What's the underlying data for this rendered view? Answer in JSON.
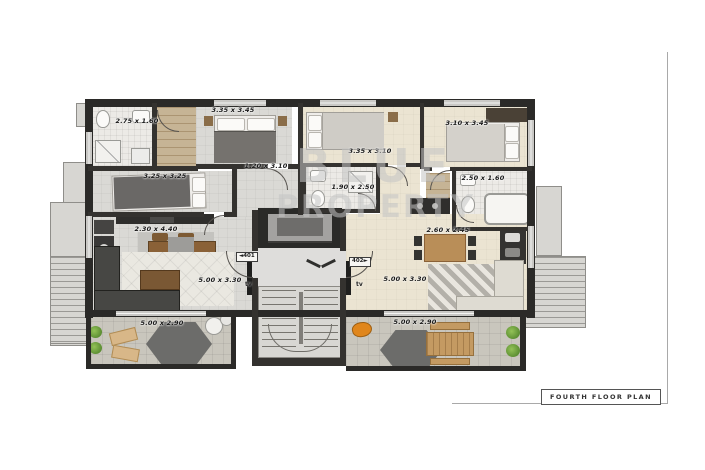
{
  "title_block": {
    "label": "FOURTH FLOOR PLAN"
  },
  "watermark": {
    "line1": "BLUE",
    "line2": "PROPERTY"
  },
  "units": {
    "left": {
      "tag": "◄401"
    },
    "right": {
      "tag": "402►"
    }
  },
  "labels": {
    "tv": "tv"
  },
  "dims": {
    "u401_bath": "2.75 x 1.60",
    "u401_bed1": "3.35 x 3.45",
    "u401_bed2": "3.25 x 3.25",
    "u401_hall": "1.20 x 3.10",
    "u401_dining": "2.30 x 4.40",
    "u401_living": "5.00 x 3.30",
    "u401_terrace": "5.00 x 2.90",
    "u402_bed1": "3.35 x 3.10",
    "u402_bath1": "1.90 x 2.50",
    "u402_bed2": "3.10 x 3.45",
    "u402_bath2": "2.50 x 1.60",
    "u402_dining": "2.60 x 2.45",
    "u402_living": "5.00 x 3.30",
    "u402_terrace": "5.00 x 2.90"
  },
  "colors": {
    "wall": "#2b2a28",
    "floor_grey": "#dad9d5",
    "floor_cream": "#ebe4d2",
    "terrace": "#c9c6bd",
    "plant_green": "#6f9e3f",
    "accent_orange": "#e0861c",
    "watermark_grey": "#c4c4c4"
  }
}
